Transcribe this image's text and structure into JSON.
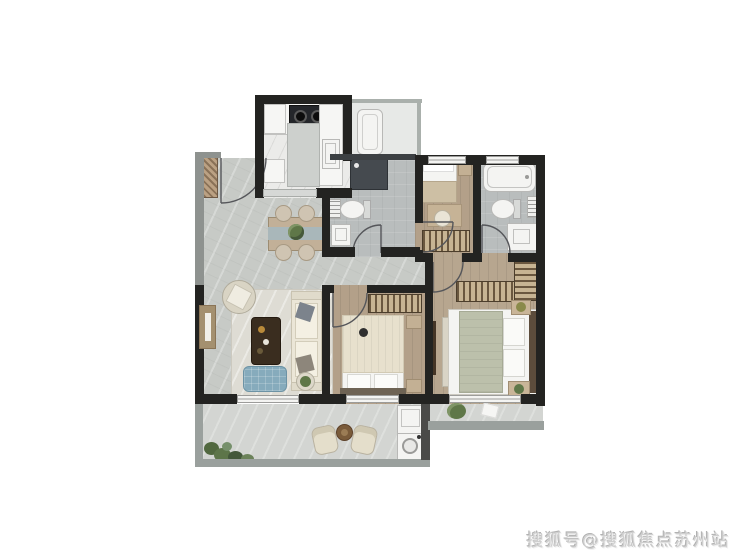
{
  "watermark": {
    "text": "搜狐号@搜狐焦点苏州站"
  },
  "palette": {
    "wall": "#232321",
    "exterior": "#8e928f",
    "railing": "#9aa09d",
    "floor_living": "#c7cac6",
    "floor_kitchen": "#ebebe9",
    "floor_bath": "#b9bdbd",
    "floor_wood": "#b3a089",
    "floor_wood_master": "#b7a68f",
    "floor_balcony": "#d3d5d2",
    "floor_service": "#e7e9e7",
    "rug": "#dedcd4",
    "sofa": "#ebe6d7",
    "coffee_table": "#3a2d1f",
    "ottoman": "#86abbc",
    "dining_table": "#c2b098",
    "runner": "#a9b7ba",
    "plant": "#5f7748",
    "shower": "#454a4f",
    "hatch_dark": "#6a573f",
    "hatch_light": "#c7b493",
    "window_frame": "#a4906f",
    "fixture": "#f4f4f2",
    "duvet": "#bcc0ab",
    "blanket": "#e7e0cd",
    "headboard": "#5c4c3c",
    "watermark_color": "#cfcfcf"
  },
  "floorplan": {
    "description": "3D rendered apartment floor plan: three bedrooms, two bathrooms, kitchen, living-dining room, service balcony, front balcony and rear terrace",
    "rooms": [
      "entry",
      "kitchen",
      "service-balcony",
      "guest-bathroom",
      "small-bedroom",
      "ensuite-bathroom",
      "dining-area",
      "living-room",
      "hallway",
      "second-bedroom",
      "master-bedroom",
      "front-balcony",
      "rear-terrace"
    ],
    "furniture": {
      "kitchen": [
        "l-counter",
        "two-burner-stove",
        "round-sink",
        "rect-sink",
        "island",
        "cabinets"
      ],
      "dining_area": [
        "dining-table",
        "table-runner",
        "centerpiece-plant",
        "chair",
        "chair",
        "chair",
        "chair"
      ],
      "living_room": [
        "rug",
        "armchair",
        "coffee-table",
        "blue-ottoman",
        "sofa",
        "throw-pillows",
        "side-table"
      ],
      "guest_bathroom": [
        "shower",
        "toilet",
        "washbasin",
        "shelf"
      ],
      "small_bedroom": [
        "single-bed",
        "nightstand",
        "desk",
        "chair",
        "wardrobe"
      ],
      "ensuite_bathroom": [
        "bathtub",
        "toilet",
        "vanity",
        "shelf"
      ],
      "second_bedroom": [
        "double-bed",
        "pillows",
        "headboard",
        "wardrobe",
        "nightstand",
        "nightstand"
      ],
      "master_bedroom": [
        "double-bed",
        "sage-duvet",
        "pillows",
        "headboard",
        "wardrobe",
        "corner-wardrobe",
        "tv-console",
        "foot-bench",
        "nightstand-plants"
      ],
      "front_balcony": [
        "planter-greenery",
        "lounge-chair",
        "lounge-chair",
        "round-table",
        "laundry-sink",
        "washing-machine"
      ],
      "rear_terrace": [
        "potted-plant",
        "door-mat"
      ],
      "service_balcony": [
        "water-heater"
      ]
    }
  }
}
